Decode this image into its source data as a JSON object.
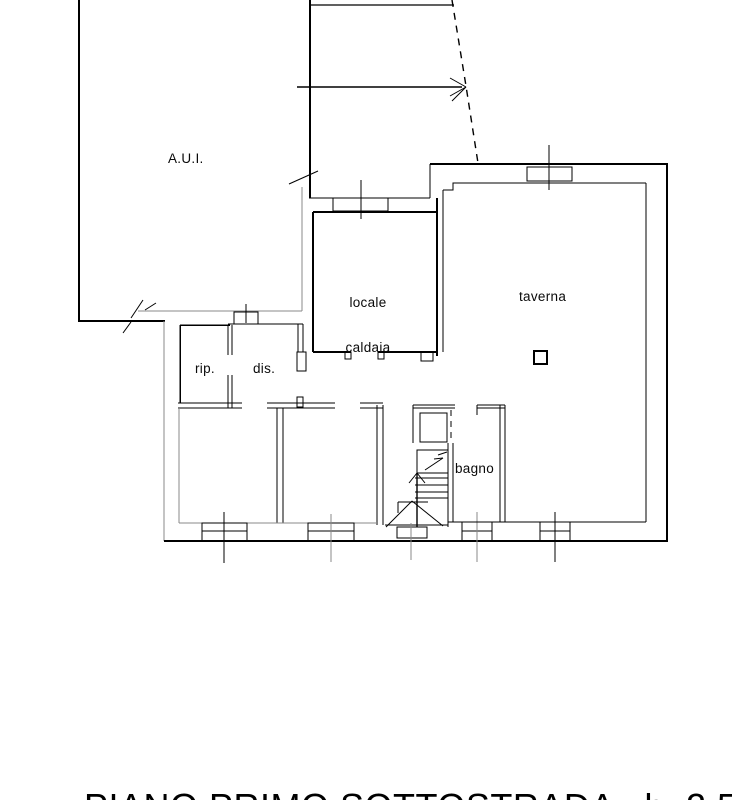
{
  "plan": {
    "rooms": {
      "aui": "A.U.I.",
      "caldaia_line1": "locale",
      "caldaia_line2": "caldaia",
      "taverna": "taverna",
      "rip": "rip.",
      "dis": "dis.",
      "bagno": "bagno"
    },
    "title": "PIANO PRIMO SOTTOSTRADA   h  2.50"
  },
  "colors": {
    "background": "#ffffff",
    "wall_line": "#000000",
    "light_line": "#888888"
  }
}
